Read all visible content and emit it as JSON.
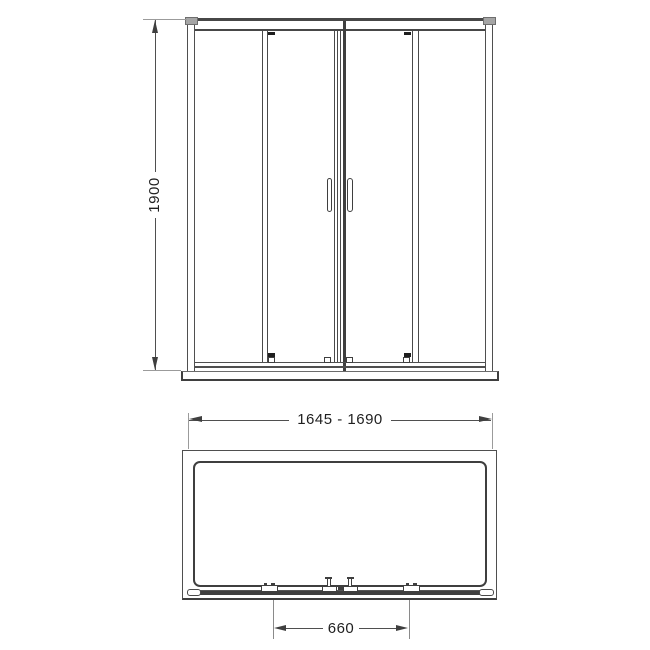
{
  "drawing": {
    "background": "#ffffff",
    "line_color": "#474747",
    "extension_line_color": "#9b9b9b",
    "text_color": "#1f1f1f",
    "front_view": {
      "height_dimension_label": "1900"
    },
    "plan_view": {
      "width_dimension_label": "1645 - 1690",
      "center_dimension_label": "660"
    }
  }
}
